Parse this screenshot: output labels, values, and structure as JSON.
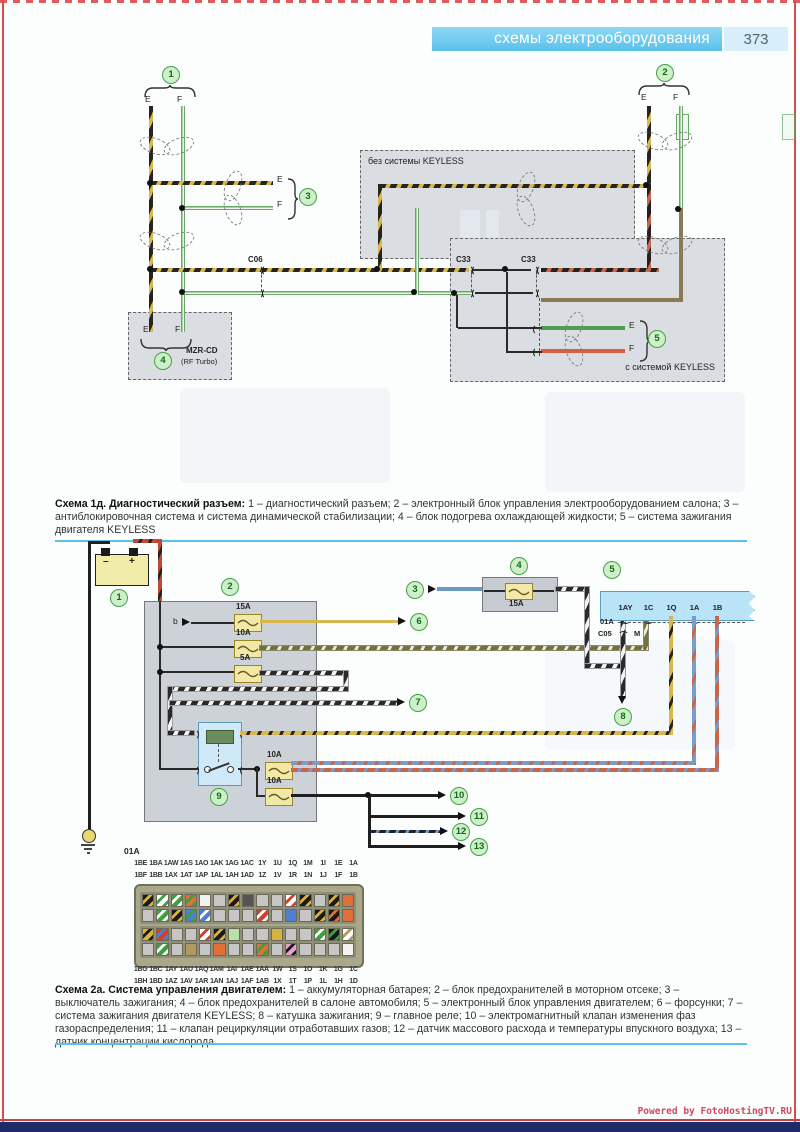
{
  "header": {
    "title": "схемы электрооборудования",
    "page_number": "373"
  },
  "d1": {
    "callouts": [
      "1",
      "2",
      "3",
      "4",
      "5"
    ],
    "wire_labels": {
      "e": "E",
      "f": "F"
    },
    "connectors": {
      "c06": "C06",
      "c33a": "C33",
      "c33b": "C33"
    },
    "boxes": {
      "no_keyless": "без системы KEYLESS",
      "with_keyless": "с системой KEYLESS",
      "mzr_line1": "MZR-CD",
      "mzr_line2": "(RF Turbo)"
    },
    "caption": {
      "title": "Схема 1д. Диагностический разъем:",
      "body": " 1 – диагностический разъем; 2 – электронный блок управления электрооборудованием салона; 3 – антиблокировочная система и система динамической стабилизации; 4 – блок подогрева охлаждающей жидкости; 5 – система зажигания двигателя KEYLESS"
    }
  },
  "d2": {
    "callouts": [
      "1",
      "2",
      "3",
      "4",
      "5",
      "6",
      "7",
      "8",
      "9",
      "10",
      "11",
      "12",
      "13"
    ],
    "battery": {
      "minus": "–",
      "plus": "+"
    },
    "fuse_labels": {
      "f1": "15A",
      "f2": "10A",
      "f3": "5A",
      "f4": "15A",
      "f5": "10A",
      "f6": "10A"
    },
    "labels": {
      "b": "b",
      "c05": "C05",
      "m": "M",
      "o1a": "01A"
    },
    "ecu_pins": [
      "1AY",
      "1C",
      "1Q",
      "1A",
      "1B"
    ],
    "caption": {
      "title": "Схема 2а. Система управления двигателем:",
      "body": " 1 – аккумуляторная батарея; 2 – блок предохранителей в моторном отсеке; 3 – выключатель зажигания; 4 – блок предохранителей в салоне автомобиля; 5 – электронный блок управления двигателем; 6 – форсунки; 7 – система зажигания двигателя KEYLESS; 8 – катушка зажигания; 9 – главное реле; 10 – электромагнитный клапан изменения фаз газораспределения; 11 – клапан рециркуляции отработавших газов; 12 – датчик массового расхода и температуры впускного воздуха; 13 – датчик концентрации кислорода"
    }
  },
  "connector_block": {
    "label": "01A",
    "pin_rows": [
      [
        "1BE",
        "1BA",
        "1AW",
        "1AS",
        "1AO",
        "1AK",
        "1AG",
        "1AC",
        "1Y",
        "1U",
        "1Q",
        "1M",
        "1I",
        "1E",
        "1A"
      ],
      [
        "1BF",
        "1BB",
        "1AX",
        "1AT",
        "1AP",
        "1AL",
        "1AH",
        "1AD",
        "1Z",
        "1V",
        "1R",
        "1N",
        "1J",
        "1F",
        "1B"
      ],
      [
        "1BG",
        "1BC",
        "1AY",
        "1AU",
        "1AQ",
        "1AM",
        "1AI",
        "1AE",
        "1AA",
        "1W",
        "1S",
        "1O",
        "1K",
        "1G",
        "1C"
      ],
      [
        "1BH",
        "1BD",
        "1AZ",
        "1AV",
        "1AR",
        "1AN",
        "1AJ",
        "1AF",
        "1AB",
        "1X",
        "1T",
        "1P",
        "1L",
        "1H",
        "1D"
      ]
    ],
    "cell_rows": [
      [
        "ky",
        "wg",
        "gw",
        "og",
        "w",
        "gy",
        "ky",
        "dk",
        "gy",
        "gy",
        "wr",
        "ky",
        "gy",
        "ky",
        "or"
      ],
      [
        "gy",
        "gw",
        "ky",
        "bg",
        "bw",
        "gy",
        "gy",
        "gy",
        "rw",
        "gy",
        "bl",
        "gy",
        "ky",
        "ko",
        "or"
      ],
      [
        "yk",
        "rb",
        "gy",
        "gy",
        "wr",
        "ky",
        "lg",
        "gy",
        "gy",
        "yo",
        "gy",
        "gy",
        "gw",
        "kg",
        "wt"
      ],
      [
        "gy",
        "gw",
        "gy",
        "tn",
        "gy",
        "or",
        "gy",
        "gy",
        "og",
        "gy",
        "pk",
        "gy",
        "gy",
        "gy",
        "w"
      ]
    ]
  },
  "footer": {
    "watermark": "Powered by FotoHostingTV.RU"
  },
  "colors": {
    "header_bar": "#6ec9ee",
    "callout_green": "#44a244",
    "separator": "#5cc1e8",
    "wire_yellow": "#d8b84e",
    "wire_green": "#4e9e50",
    "wire_orange": "#d06040",
    "wire_blue": "#6a9ac8",
    "wire_brown": "#8a7a52",
    "bottom_bar": "#1d2c66"
  }
}
